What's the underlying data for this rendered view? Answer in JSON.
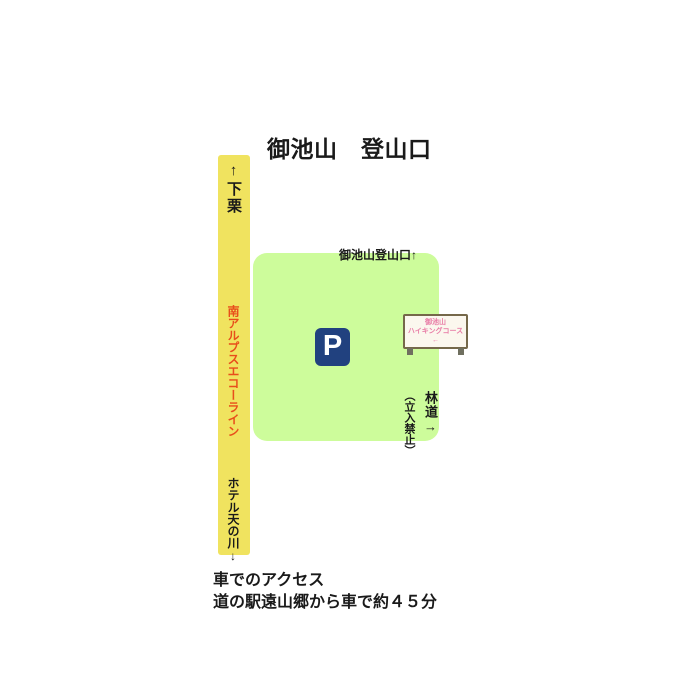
{
  "title": {
    "text": "御池山　登山口"
  },
  "road": {
    "color": "#f0e35f",
    "top_label": "↑下栗",
    "name_label": "南アルプスエコーライン",
    "name_color": "#e84e1b",
    "bottom_label": "ホテル天の川↓"
  },
  "parking_area": {
    "color": "#cdfc9b",
    "trailhead_label": "御池山登山口↑",
    "parking_icon": {
      "letter": "P",
      "bg_color": "#21417f",
      "text_color": "#ffffff"
    }
  },
  "signboard": {
    "line1": "御池山",
    "line2": "ハイキングコース",
    "line3": "←",
    "text_color": "#e87ca6",
    "frame_color": "#75684a",
    "face_color": "#fbf7ee"
  },
  "forest_road": {
    "label": "林道→",
    "restriction": "（立入禁止）"
  },
  "access": {
    "line1": "車でのアクセス",
    "line2": "道の駅遠山郷から車で約４５分"
  }
}
